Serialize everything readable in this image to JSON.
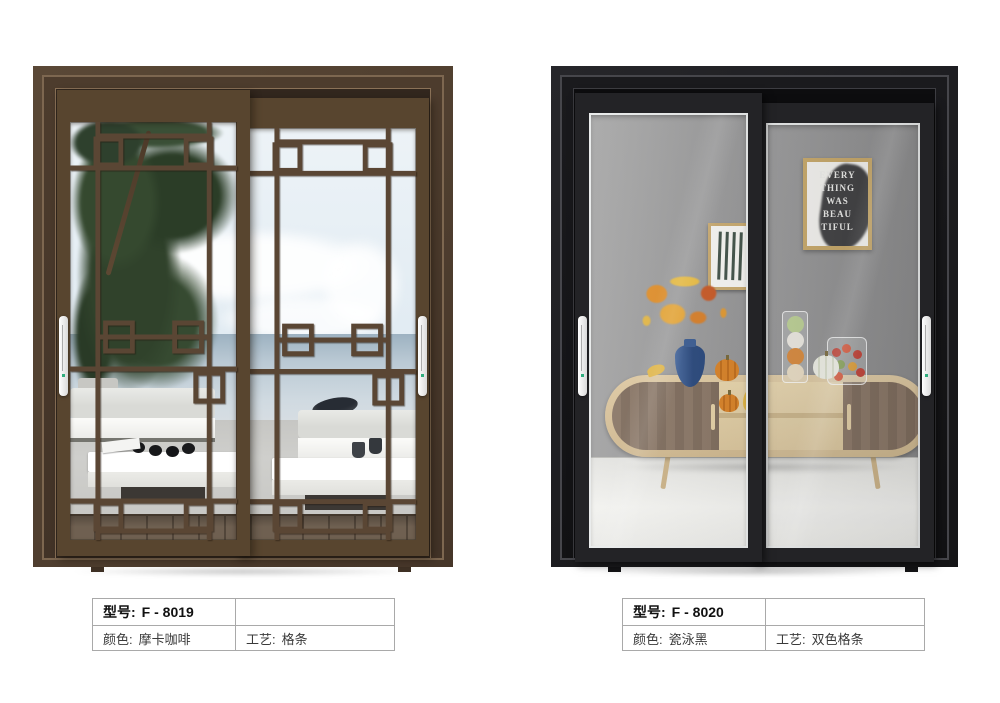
{
  "page": {
    "background": "#ffffff"
  },
  "products": [
    {
      "model_label": "型号:",
      "model_value": "F - 8019",
      "color_label": "颜色:",
      "color_value": "摩卡咖啡",
      "craft_label": "工艺:",
      "craft_value": "格条",
      "frame_color": "#4e3d2e",
      "lattice_color": "#5a4634",
      "handle_color": "#ffffff",
      "handle_dot_color": "#2fae7e"
    },
    {
      "model_label": "型号:",
      "model_value": "F - 8020",
      "color_label": "颜色:",
      "color_value": "瓷泳黑",
      "craft_label": "工艺:",
      "craft_value": "双色格条",
      "frame_color": "#1d1d1f",
      "accent_line_color": "#e9ebeb",
      "handle_color": "#ffffff",
      "handle_dot_color": "#2fae7e",
      "poster_lines": [
        "EVERY",
        "THING",
        "WAS",
        "BEAU",
        "TIFUL"
      ]
    }
  ]
}
